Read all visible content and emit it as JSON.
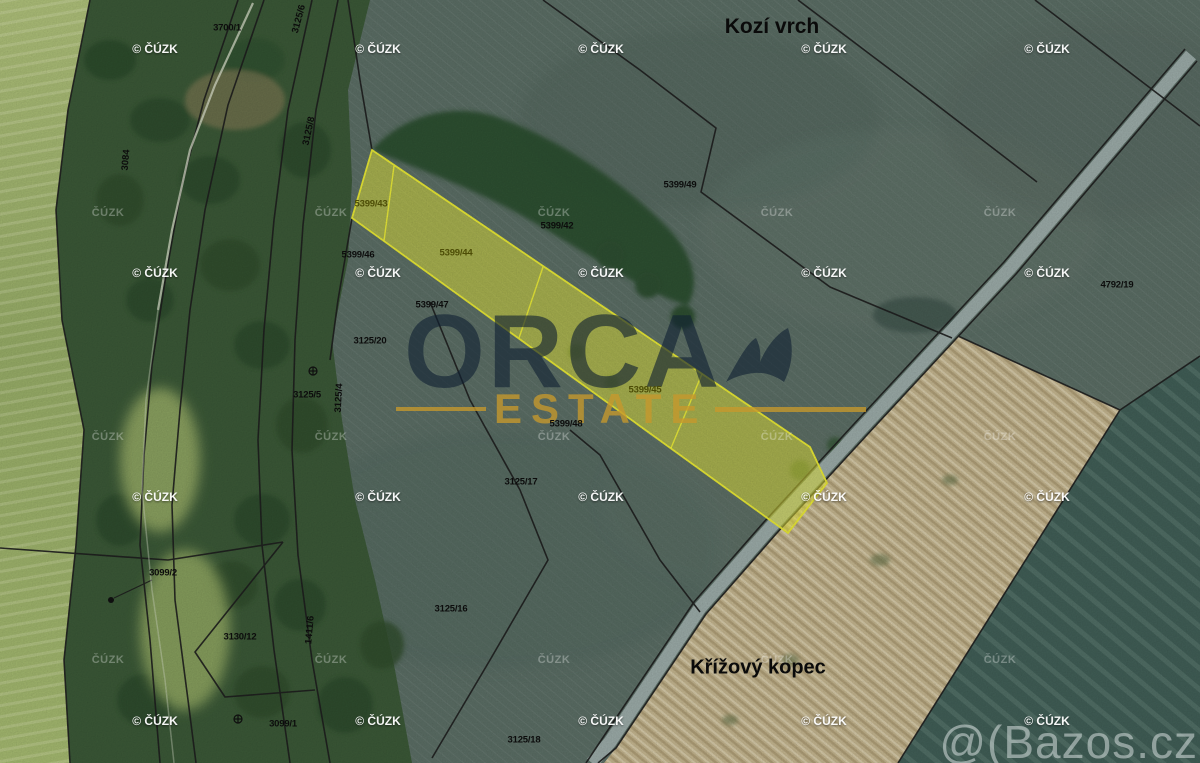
{
  "place_labels": [
    {
      "text": "Kozí vrch",
      "x": 772,
      "y": 27,
      "size": 21
    },
    {
      "text": "Křížový kopec",
      "x": 758,
      "y": 668,
      "size": 20
    }
  ],
  "parcel_labels": [
    {
      "text": "3700/1",
      "x": 227,
      "y": 28
    },
    {
      "text": "5399/49",
      "x": 680,
      "y": 185
    },
    {
      "text": "5399/42",
      "x": 557,
      "y": 226
    },
    {
      "text": "5399/43",
      "x": 371,
      "y": 204,
      "olive": true
    },
    {
      "text": "5399/44",
      "x": 456,
      "y": 253,
      "olive": true
    },
    {
      "text": "5399/46",
      "x": 358,
      "y": 255
    },
    {
      "text": "5399/47",
      "x": 432,
      "y": 305
    },
    {
      "text": "3125/20",
      "x": 370,
      "y": 341
    },
    {
      "text": "3125/5",
      "x": 307,
      "y": 395
    },
    {
      "text": "5399/45",
      "x": 645,
      "y": 390,
      "olive": true
    },
    {
      "text": "5399/48",
      "x": 566,
      "y": 424
    },
    {
      "text": "3125/17",
      "x": 521,
      "y": 482
    },
    {
      "text": "4792/19",
      "x": 1117,
      "y": 285
    },
    {
      "text": "3099/2",
      "x": 163,
      "y": 573
    },
    {
      "text": "3125/16",
      "x": 451,
      "y": 609
    },
    {
      "text": "3130/12",
      "x": 240,
      "y": 637
    },
    {
      "text": "3099/1",
      "x": 283,
      "y": 724
    },
    {
      "text": "3125/18",
      "x": 524,
      "y": 740
    }
  ],
  "vertical_labels": [
    {
      "text": "3125/6",
      "x": 299,
      "y": 19,
      "rot": -75
    },
    {
      "text": "3084",
      "x": 126,
      "y": 160,
      "rot": -85
    },
    {
      "text": "3125/8",
      "x": 309,
      "y": 131,
      "rot": -78
    },
    {
      "text": "3125/4",
      "x": 339,
      "y": 398,
      "rot": -87
    },
    {
      "text": "1411/6",
      "x": 310,
      "y": 630,
      "rot": -85
    }
  ],
  "watermarks": {
    "cuzk": "© ČÚZK",
    "cuzk_faint": "ČÚZK",
    "bazos": "@(Bazos.cz",
    "bright_grid": {
      "cols": [
        155,
        378,
        601,
        824,
        1047
      ],
      "rows": [
        49,
        273,
        497,
        721
      ]
    },
    "faint_grid": {
      "cols": [
        108,
        331,
        554,
        777,
        1000
      ],
      "rows": [
        213,
        437,
        660
      ]
    }
  },
  "logo": {
    "line1": "ORCA",
    "line2": "ESTATE"
  },
  "palette": {
    "parcel_highlight": "#eff03c",
    "parcel_highlight_edge": "#f4f437",
    "orca_navy": "rgba(16,32,50,0.62)",
    "estate_gold": "rgba(198,152,44,0.78)",
    "bazos_gray": "rgba(230,236,236,0.5)",
    "watermark_white": "#ffffff",
    "field_gray_green": "#5d7067",
    "forest_green": "#3c5a38",
    "bright_field_green": "#a8bd72",
    "dry_field_beige": "#c8b992",
    "dark_crop_teal": "#426058",
    "road_gray": "#9eaeab"
  }
}
